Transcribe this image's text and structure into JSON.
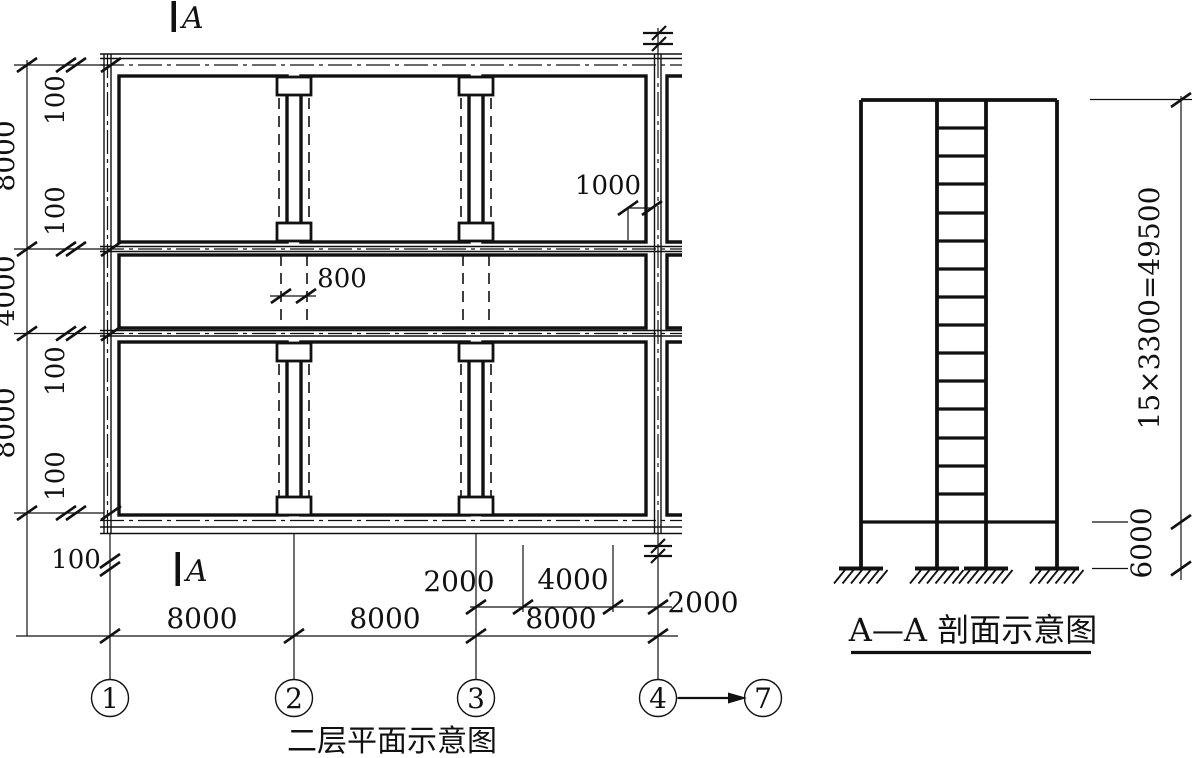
{
  "plan": {
    "title": "二层平面示意图",
    "section_cut_label": "A",
    "grid_bubbles": [
      "1",
      "2",
      "3",
      "4",
      "7"
    ],
    "dims": {
      "left_chain": [
        "8000",
        "4000",
        "8000"
      ],
      "wall_offsets": [
        "100",
        "100",
        "100",
        "100"
      ],
      "grid1_offset": "100",
      "bottom_spans": [
        "8000",
        "8000",
        "8000"
      ],
      "bottom_sub_spans": [
        "2000",
        "4000",
        "2000"
      ],
      "column_width": "800",
      "end_bay_offset": "1000"
    }
  },
  "section": {
    "title": "A—A 剖面示意图",
    "story_dim": "15×3300=49500",
    "ground_story_dim": "6000",
    "intermediate_floor_lines": 14,
    "columns": 4
  },
  "colors": {
    "ink": "#111111",
    "paper": "#ffffff"
  }
}
